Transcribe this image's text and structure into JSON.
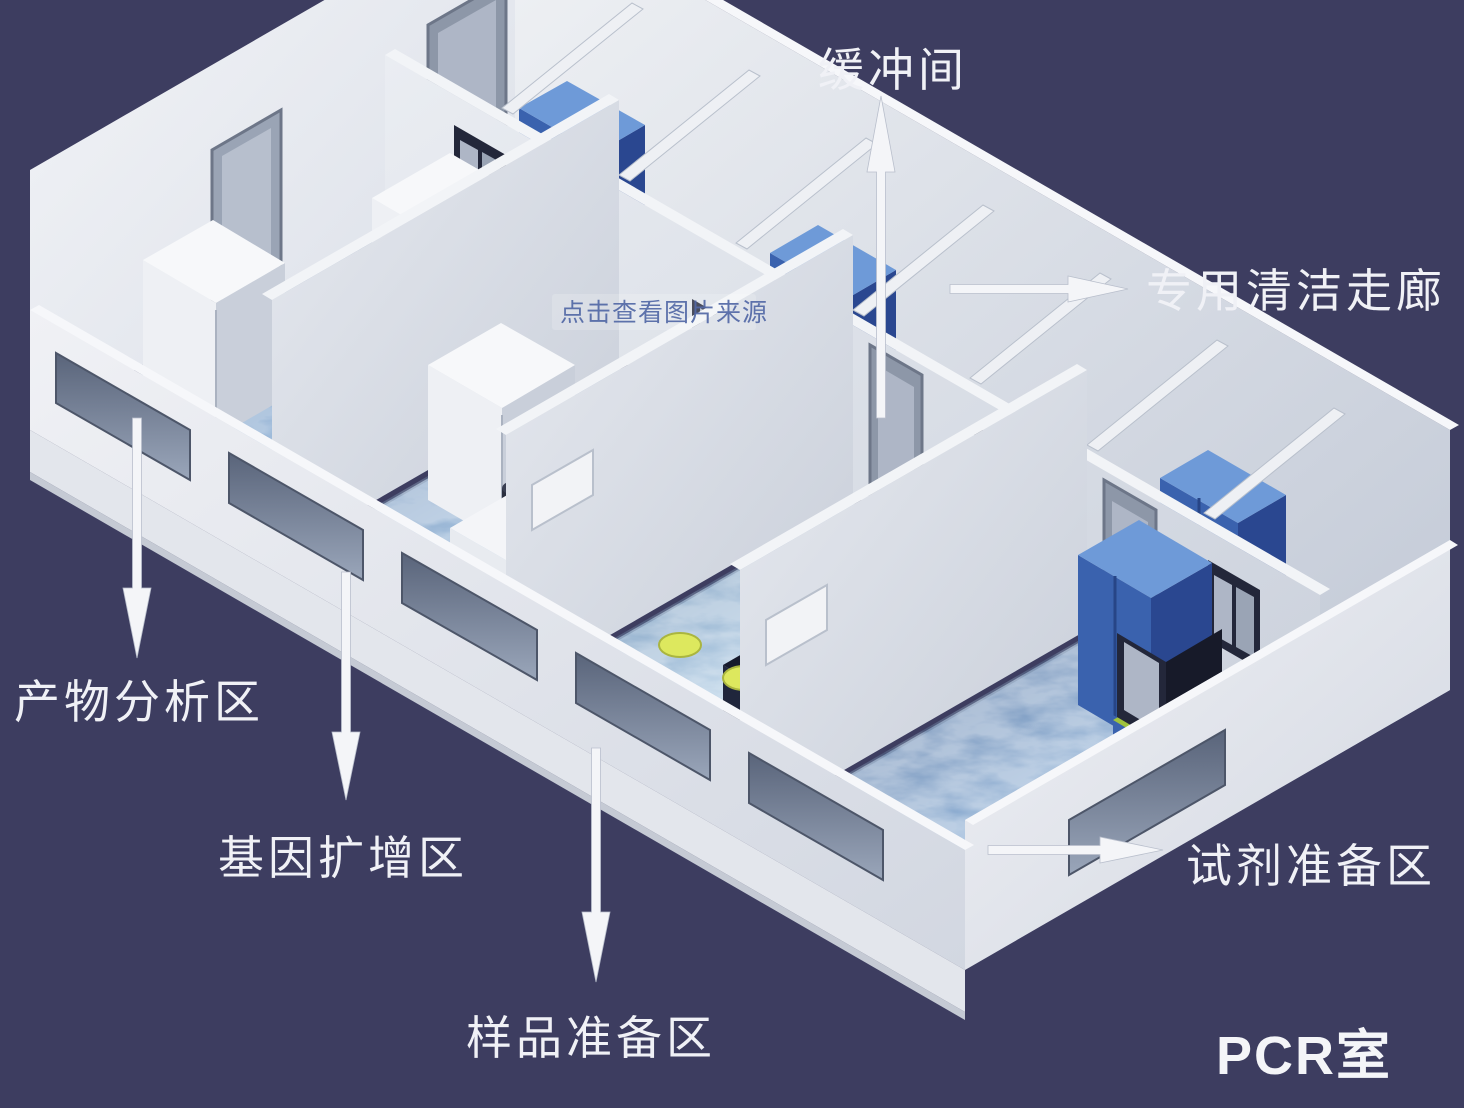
{
  "scene": {
    "description": "3D isometric cutaway rendering of a PCR laboratory floor plan on a dark navy background",
    "background_color": "#3d3d60",
    "watermark": "点击查看图片来源"
  },
  "labels": {
    "buffer_room": "缓冲间",
    "clean_corridor": "专用清洁走廊",
    "product_analysis": "产物分析区",
    "gene_amplification": "基因扩增区",
    "sample_preparation": "样品准备区",
    "reagent_preparation": "试剂准备区",
    "pcr_room": "PCR室"
  },
  "rooms": [
    {
      "name": "产物分析区",
      "position": "far-left room",
      "floor": "blue"
    },
    {
      "name": "基因扩增区",
      "position": "second room from left",
      "floor": "blue"
    },
    {
      "name": "样品准备区",
      "position": "third room from left",
      "floor": "blue"
    },
    {
      "name": "试剂准备区",
      "position": "far-right room",
      "floor": "blue"
    },
    {
      "name": "缓冲间",
      "position": "row of small buffer rooms along the back of each lab room"
    },
    {
      "name": "专用清洁走廊",
      "position": "dedicated clean corridor along the back outer wall"
    }
  ],
  "colors": {
    "background": "#3d3d60",
    "wall_light": "#f1f2f5",
    "wall_shade": "#c9cfda",
    "floor_blue": "#6f9ac8",
    "cabinet_blue": "#3a62ae",
    "cabinet_blue_dark": "#2a4790",
    "stool_yellow": "#dde85e",
    "bench_dark": "#161a2c",
    "label_text": "#f0f1f6",
    "arrow_white": "#f4f5f8"
  }
}
